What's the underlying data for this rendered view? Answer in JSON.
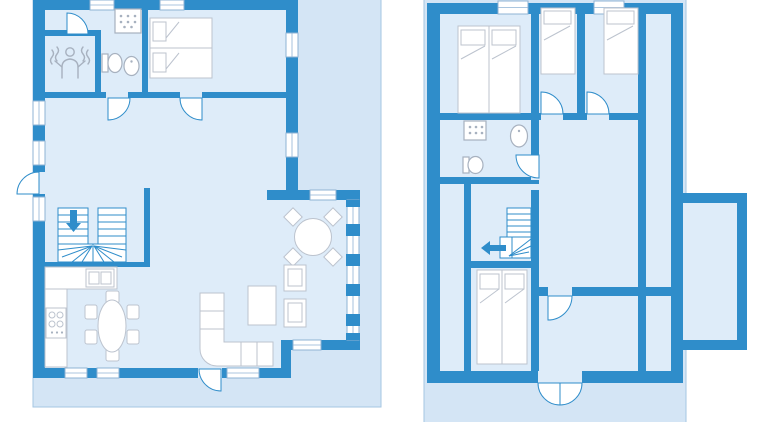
{
  "colors": {
    "page_bg": "#ffffff",
    "backdrop": "#d4e5f5",
    "backdrop_border": "#a5c6e2",
    "room_fill": "#deecf9",
    "wall": "#2f8dca",
    "furniture_fill": "#ffffff",
    "furniture_stroke": "#bcc3ce",
    "fixture_stroke": "#a7b1bf",
    "door_stroke": "#2f8dca",
    "stair_stroke": "#2f8dca",
    "window_stroke": "#8fb3d4",
    "arrow": "#2f8dca"
  },
  "figure": {
    "type": "floor-plan",
    "plan_count": 2
  },
  "plans": [
    {
      "id": "ground-floor-plan",
      "areas": [
        "sauna-room",
        "bathroom",
        "bedroom",
        "living-room",
        "kitchen",
        "dining-area",
        "terrace"
      ],
      "icons": [
        "sauna-person-icon",
        "shower-icon",
        "toilet-icon",
        "sink-icon",
        "double-bed-icon",
        "staircase-icon",
        "down-arrow-icon",
        "kitchen-counter-icon",
        "kitchen-sink-icon",
        "stove-icon",
        "dining-table-icon",
        "chair-icon",
        "round-table-icon",
        "corner-sofa-icon",
        "coffee-table-icon",
        "armchair-icon",
        "door-arc-icon",
        "window-icon"
      ]
    },
    {
      "id": "upper-floor-plan",
      "areas": [
        "double-bedroom",
        "single-bedroom-1",
        "single-bedroom-2",
        "bathroom",
        "landing",
        "twin-bedroom",
        "room",
        "side-attic-strips",
        "balcony",
        "terrace"
      ],
      "icons": [
        "double-bed-icon",
        "single-bed-icon",
        "twin-beds-icon",
        "shower-icon",
        "toilet-icon",
        "sink-icon",
        "staircase-icon",
        "left-arrow-icon",
        "door-arc-icon",
        "double-door-icon",
        "window-icon"
      ]
    }
  ]
}
